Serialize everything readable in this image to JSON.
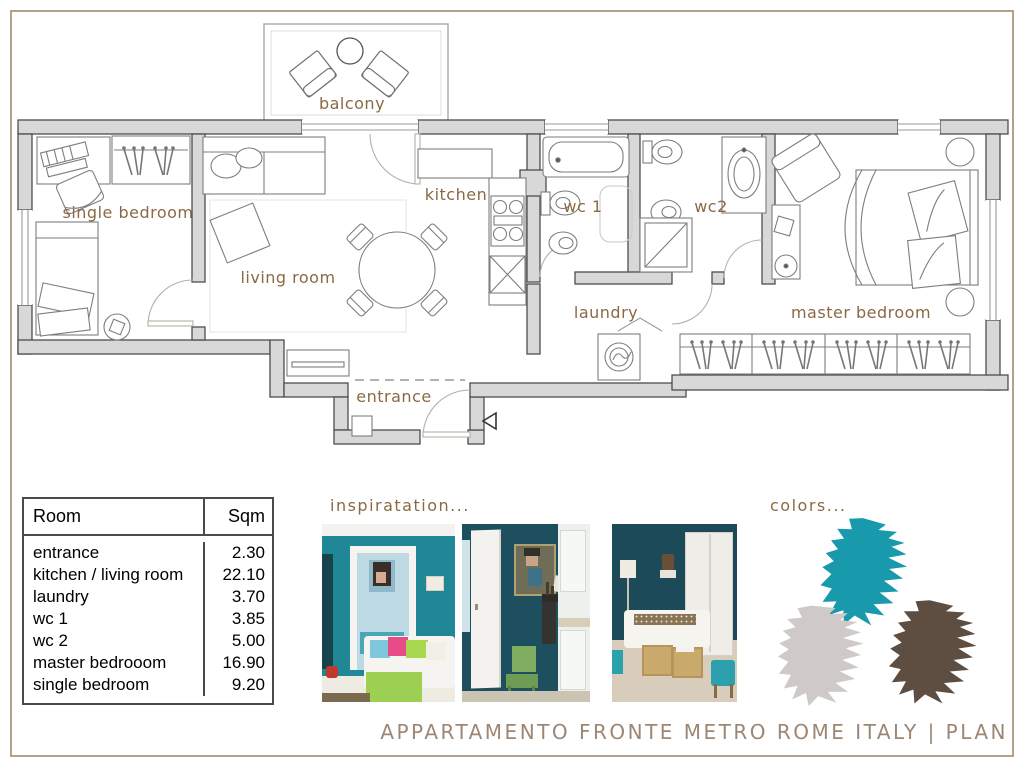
{
  "plan": {
    "labels": {
      "balcony": "balcony",
      "single_bedroom": "single bedroom",
      "living_room": "living room",
      "kitchen": "kitchen",
      "wc1": "wc 1",
      "wc2": "wc2",
      "laundry": "laundry",
      "entrance": "entrance",
      "master_bedroom": "master bedroom"
    }
  },
  "area_table": {
    "col_room": "Room",
    "col_sqm": "Sqm",
    "rows": [
      {
        "room": "entrance",
        "sqm": "2.30"
      },
      {
        "room": "kitchen / living room",
        "sqm": "22.10"
      },
      {
        "room": "laundry",
        "sqm": "3.70"
      },
      {
        "room": "wc 1",
        "sqm": "3.85"
      },
      {
        "room": "wc 2",
        "sqm": "5.00"
      },
      {
        "room": "master bedrooom",
        "sqm": "16.90"
      },
      {
        "room": "single bedroom",
        "sqm": "9.20"
      }
    ]
  },
  "inspiration_label": "inspiratation...",
  "colors_label": "colors...",
  "swatches": [
    {
      "name": "teal",
      "hex": "#1899AC"
    },
    {
      "name": "light-gray",
      "hex": "#CFCAC7"
    },
    {
      "name": "dark-brown",
      "hex": "#5E4E41"
    }
  ],
  "footer_title": "APPARTAMENTO FRONTE METRO ROME ITALY | PLAN"
}
